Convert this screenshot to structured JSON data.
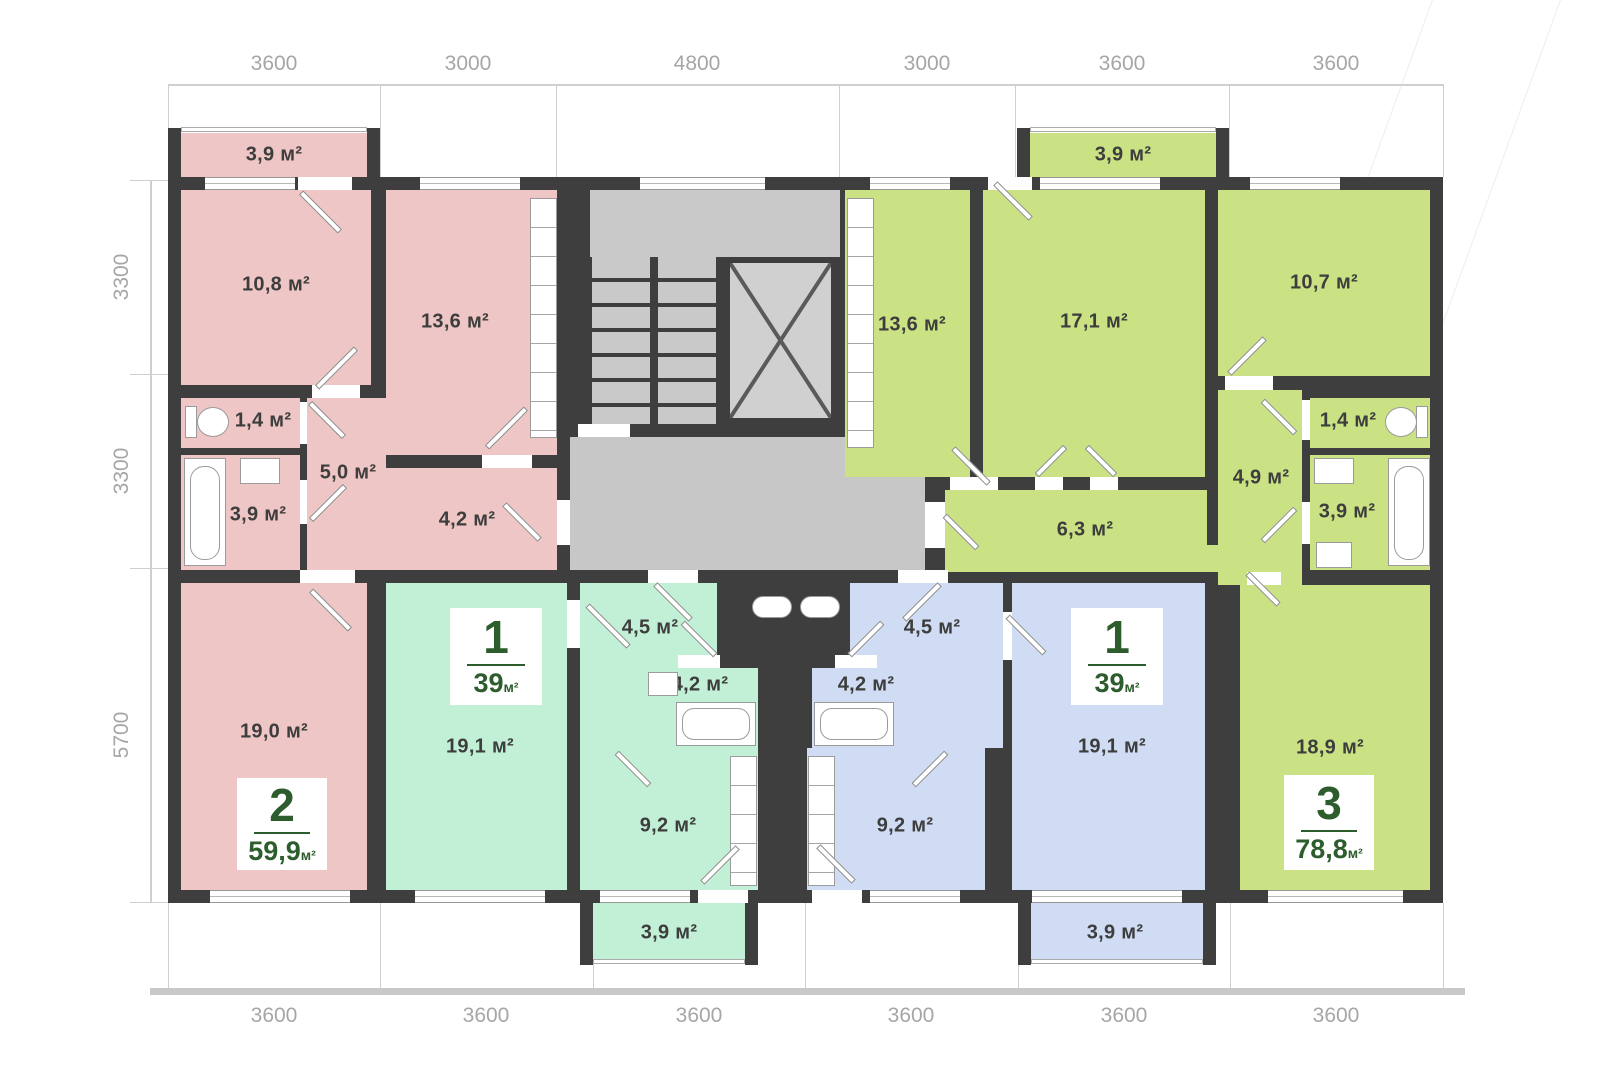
{
  "dimensions": {
    "top": [
      "3600",
      "3000",
      "4800",
      "3000",
      "3600",
      "3600"
    ],
    "left": [
      "3300",
      "3300",
      "5700"
    ],
    "bottom": [
      "3600",
      "3600",
      "3600",
      "3600",
      "3600",
      "3600"
    ]
  },
  "apartments": {
    "apt_2_pink": {
      "number": "2",
      "area": "59,9",
      "area_unit": "м²",
      "rooms": {
        "balcony": "3,9 м²",
        "bedroom": "10,8 м²",
        "kitchen": "13,6 м²",
        "wc": "1,4 м²",
        "hall": "5,0 м²",
        "bathroom": "3,9 м²",
        "corridor": "4,2 м²",
        "living": "19,0 м²"
      }
    },
    "apt_1_mint": {
      "number": "1",
      "area": "39",
      "area_unit": "м²",
      "rooms": {
        "living": "19,1 м²",
        "hall": "4,5 м²",
        "bathroom": "4,2 м²",
        "kitchen": "9,2 м²",
        "balcony": "3,9 м²"
      }
    },
    "apt_1_blue": {
      "number": "1",
      "area": "39",
      "area_unit": "м²",
      "rooms": {
        "living": "19,1 м²",
        "hall": "4,5 м²",
        "bathroom": "4,2 м²",
        "kitchen": "9,2 м²",
        "balcony": "3,9 м²"
      }
    },
    "apt_3_lime": {
      "number": "3",
      "area": "78,8",
      "area_unit": "м²",
      "rooms": {
        "balcony": "3,9 м²",
        "kitchen": "13,6 м²",
        "living": "17,1 м²",
        "bedroom": "10,7 м²",
        "wc": "1,4 м²",
        "hall": "4,9 м²",
        "bathroom": "3,9 м²",
        "corridor": "6,3 м²",
        "bedroom2": "18,9 м²"
      }
    }
  },
  "colors": {
    "pink": "#eec6c5",
    "mint": "#c2f0d6",
    "blue": "#cfdcf3",
    "lime": "#cbe284",
    "wall": "#3e3e3e",
    "corridor_gray": "#c7c7c7",
    "badge_green": "#2d5c2d",
    "dim_text": "#a6a6a6",
    "room_text": "#3d3d3d"
  }
}
